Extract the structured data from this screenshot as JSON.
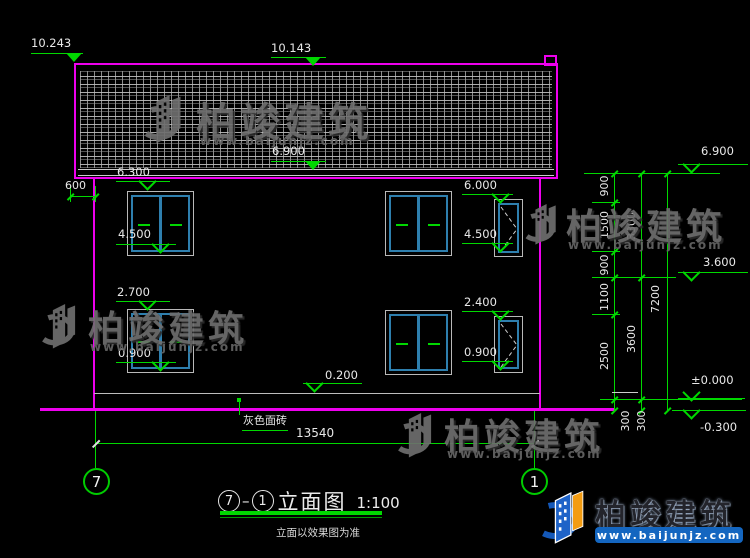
{
  "brand": {
    "name": "柏竣建筑",
    "site": "www.baijunjz.com"
  },
  "title_block": {
    "axis_left": "7",
    "dash": "–",
    "axis_right": "1",
    "name": "立面图",
    "scale": "1:100",
    "note": "立面以效果图为准"
  },
  "labels": {
    "material": "灰色面砖",
    "overhang": "600",
    "total_width": "13540"
  },
  "levels": {
    "roof_left": "10.243",
    "roof_ridge": "10.143",
    "eave_left": "6.900",
    "w2_head_left": "6.300",
    "w2_sill_left": "4.500",
    "w1_head_left": "2.700",
    "w1_sill_left": "0.900",
    "w2_head_mid": "6.000",
    "w2_sill_mid": "4.500",
    "w1_head_mid": "2.400",
    "w1_sill_mid": "0.900",
    "plinth": "0.200",
    "eave_right": "6.900",
    "floor2_right": "3.600",
    "zero": "±0.000",
    "minus300": "-0.300"
  },
  "chains": {
    "inner": [
      "900",
      "1500",
      "900",
      "1100",
      "2500"
    ],
    "inner_base": "300",
    "mid": [
      "3300",
      "3600"
    ],
    "mid_base": "300",
    "outer": "7200"
  },
  "bubbles": {
    "left": "7",
    "right": "1"
  },
  "colors": {
    "line_green": "#00d800",
    "outline_magenta": "#ee00ee",
    "window_blue": "#2e7fae",
    "band_blue": "#1466c0",
    "logo_orange": "#f39c12",
    "logo_blue": "#1e63c8"
  }
}
